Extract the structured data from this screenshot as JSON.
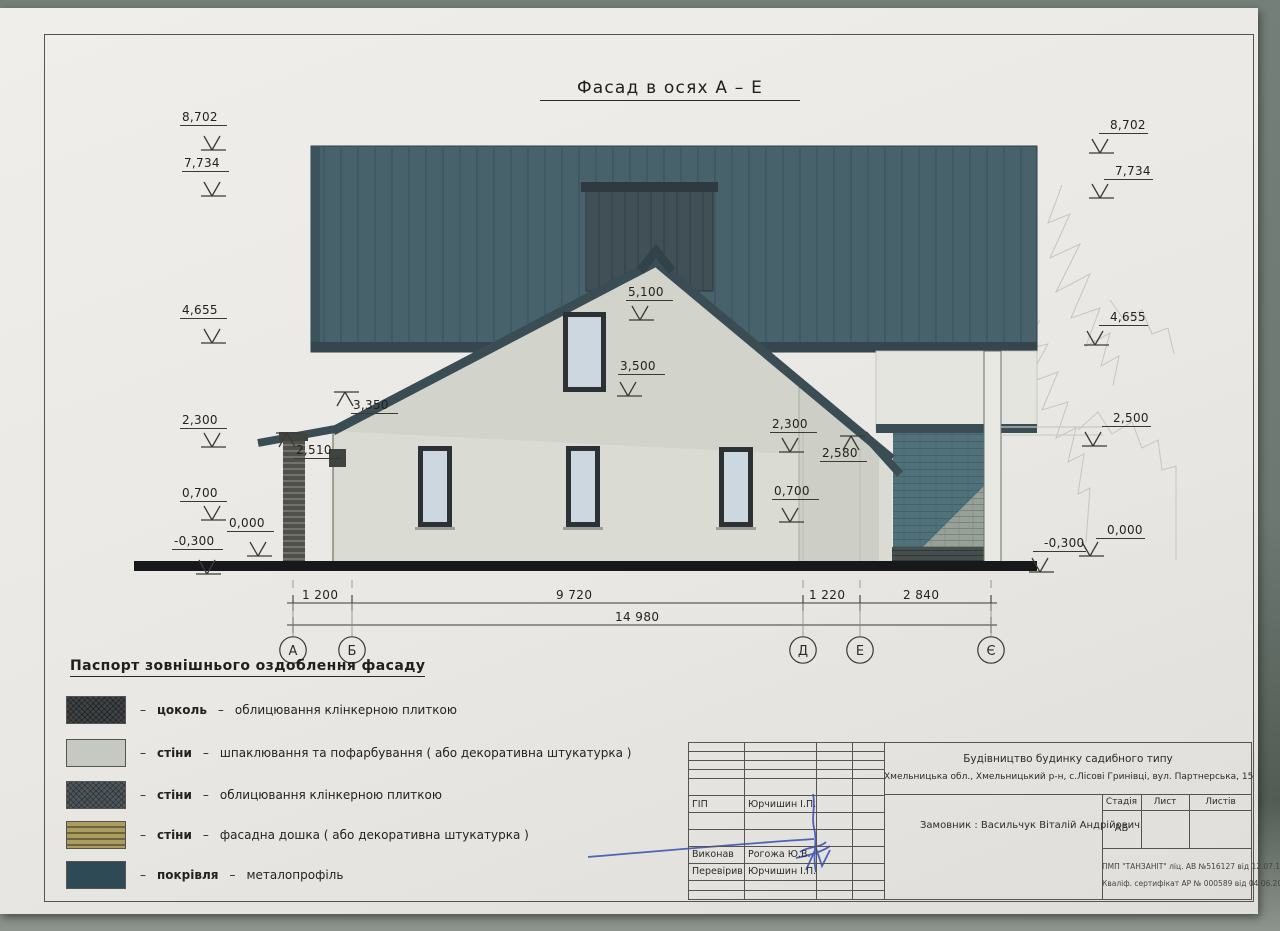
{
  "title": "Фасад в осях  А – Е",
  "elevation_marks": {
    "left": [
      "8,702",
      "7,734",
      "4,655",
      "2,300",
      "0,700",
      "0,000",
      "-0,300"
    ],
    "right": [
      "8,702",
      "7,734",
      "4,655",
      "2,500",
      "0,000",
      "-0,300"
    ]
  },
  "facade_dims": {
    "ridge": "5,100",
    "gable_window": "3,500",
    "eave_left": "3,350",
    "porch_left": "2,510",
    "wall_right": "2,300",
    "eave_right": "2,580",
    "sill_right": "0,700"
  },
  "bottom_dims": {
    "segments": [
      "1 200",
      "9 720",
      "1 220",
      "2 840"
    ],
    "total": "14 980"
  },
  "axes": [
    "А",
    "Б",
    "Д",
    "Е",
    "Є"
  ],
  "legend": {
    "heading": "Паспорт зовнішнього оздоблення фасаду",
    "dash": "–",
    "items": [
      {
        "name": "цоколь",
        "desc": "облицювання клінкерною плиткою",
        "swatch": "dark-clinker-hatch"
      },
      {
        "name": "стіни",
        "desc": "шпаклювання та пофарбування ( або декоративна штукатурка )",
        "swatch": "light-plaster"
      },
      {
        "name": "стіни",
        "desc": "облицювання клінкерною плиткою",
        "swatch": "gray-clinker-hatch"
      },
      {
        "name": "стіни",
        "desc": "фасадна дошка ( або декоративна штукатурка )",
        "swatch": "tan-board-stripes"
      },
      {
        "name": "покрівля",
        "desc": "металопрофіль",
        "swatch": "teal-metal"
      }
    ]
  },
  "title_block": {
    "project_line1": "Будівництво будинку садибного типу",
    "project_line2": "Хмельницька обл.,  Хмельницький р-н, с.Лісові Гринівці, вул. Партнерська, 15",
    "client": "Замовник :  Васильчук Віталій Андрійович",
    "roles": [
      {
        "role": "ГІП",
        "name": "Юрчишин І.П."
      },
      {
        "role": "Виконав",
        "name": "Рогожа Ю.В."
      },
      {
        "role": "Перевірив",
        "name": "Юрчишин І.П."
      }
    ],
    "stage_cols": [
      "Стадія",
      "Лист",
      "Листів"
    ],
    "stage_value": "АБ",
    "license_line1": "ПМП \"ТАНЗАНІТ\"  ліц. АВ №516127 від 12.07.10р",
    "license_line2": "Кваліф. сертифікат АР № 000589 від 04.06.2012 р."
  },
  "colors": {
    "roof_metal": "#48626c",
    "eave": "#3a4c54",
    "gable_wall": "#d2d4cb",
    "main_wall": "#dadbd3",
    "teal_brick": "#50707a",
    "paper": "#eceae6",
    "signature_ink": "#3b55b5"
  }
}
